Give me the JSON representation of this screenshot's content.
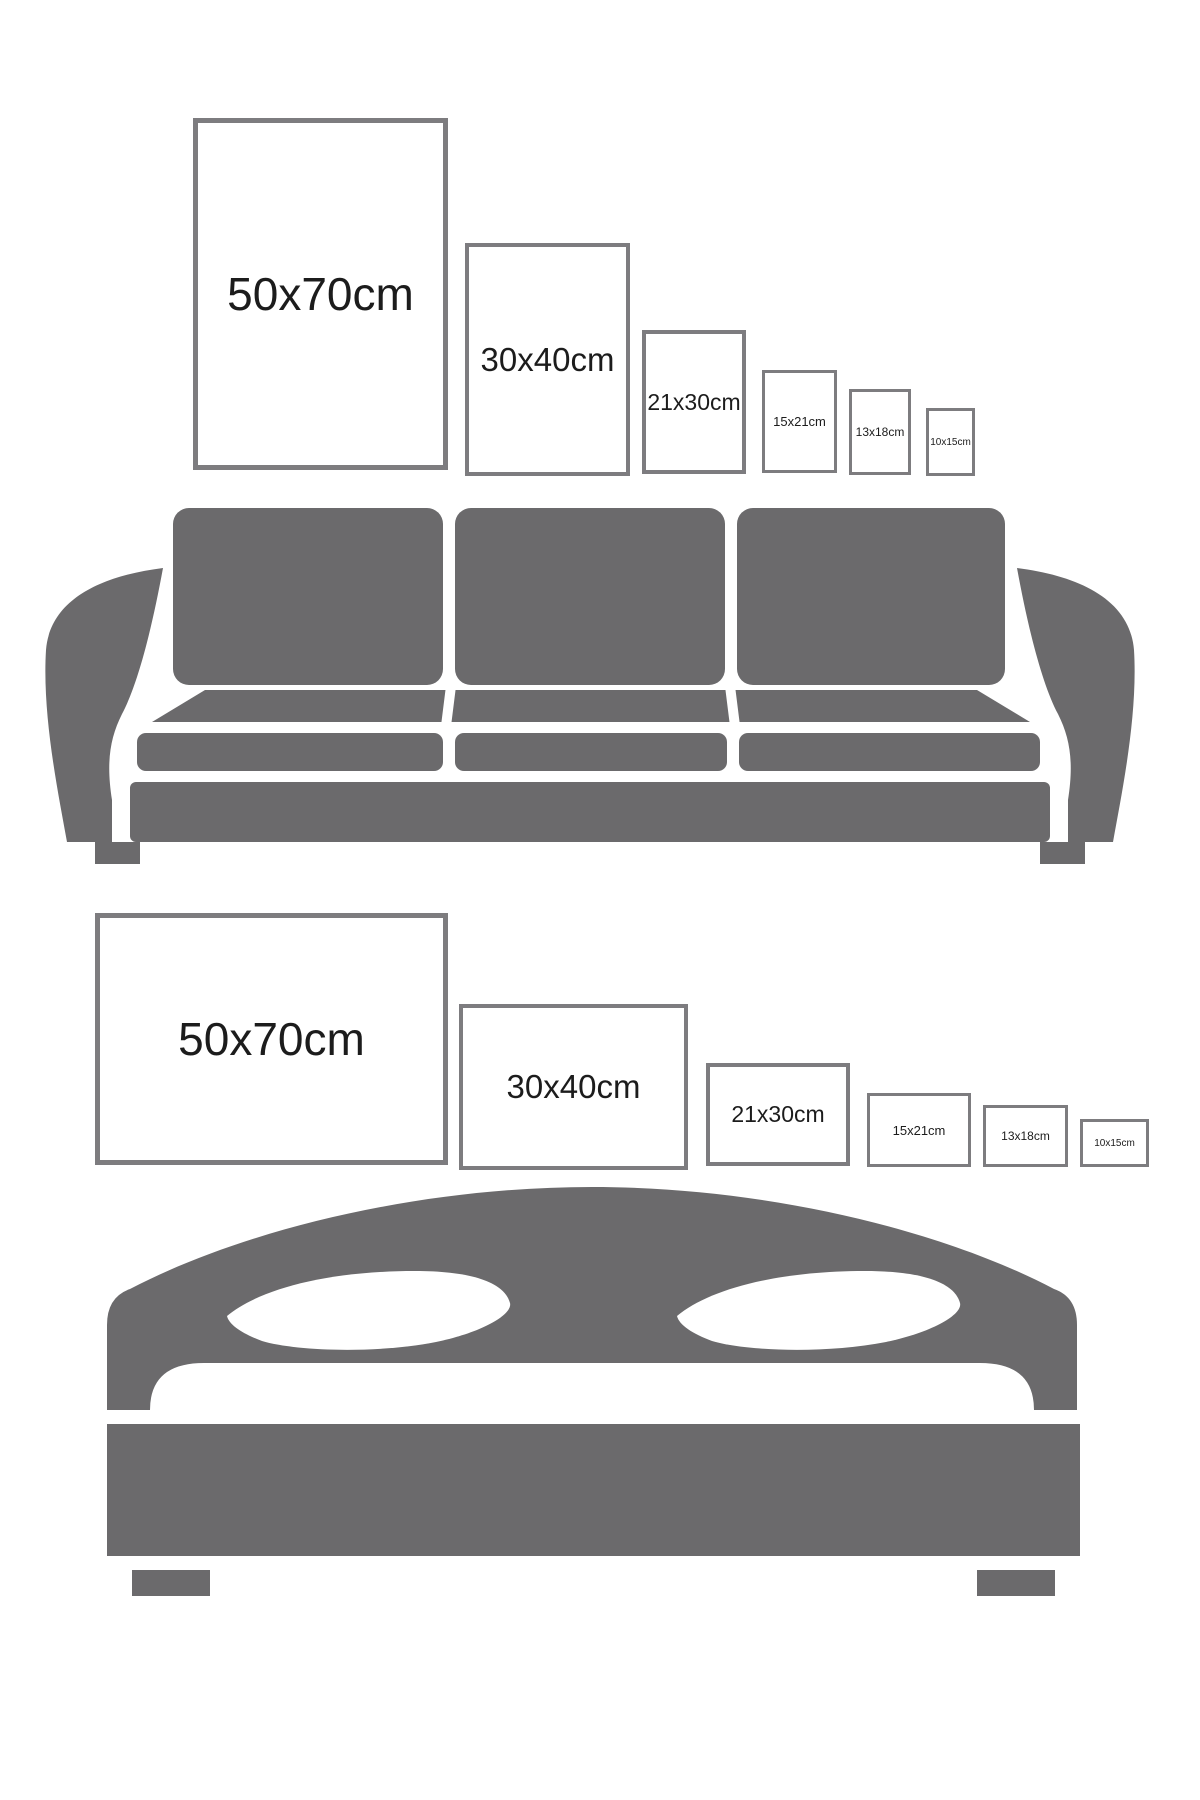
{
  "colors": {
    "background": "#ffffff",
    "furniture_silhouette": "#6b6a6c",
    "frame_border": "#7d7c7f",
    "label_text": "#1c1c1c"
  },
  "sections": [
    {
      "id": "sofa-size-guide",
      "furniture": "sofa",
      "orientation": "portrait",
      "frames": [
        {
          "label": "50x70cm"
        },
        {
          "label": "30x40cm"
        },
        {
          "label": "21x30cm"
        },
        {
          "label": "15x21cm"
        },
        {
          "label": "13x18cm"
        },
        {
          "label": "10x15cm"
        }
      ]
    },
    {
      "id": "bed-size-guide",
      "furniture": "bed",
      "orientation": "landscape",
      "frames": [
        {
          "label": "50x70cm"
        },
        {
          "label": "30x40cm"
        },
        {
          "label": "21x30cm"
        },
        {
          "label": "15x21cm"
        },
        {
          "label": "13x18cm"
        },
        {
          "label": "10x15cm"
        }
      ]
    }
  ]
}
